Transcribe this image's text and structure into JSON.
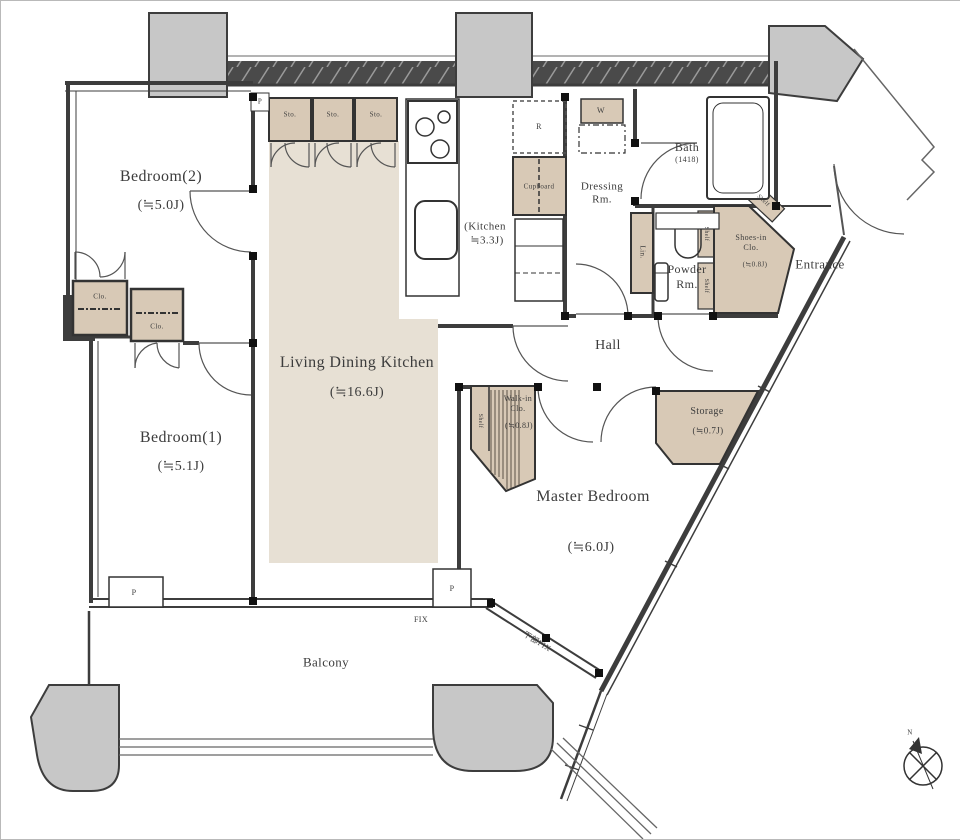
{
  "rooms": {
    "bedroom2": {
      "name": "Bedroom(2)",
      "size": "(≒5.0J)"
    },
    "bedroom1": {
      "name": "Bedroom(1)",
      "size": "(≒5.1J)"
    },
    "ldk": {
      "name": "Living Dining Kitchen",
      "size": "(≒16.6J)"
    },
    "kitchen": {
      "name": "(Kitchen",
      "size": "≒3.3J)"
    },
    "dressing": {
      "line1": "Dressing",
      "line2": "Rm."
    },
    "bath": {
      "name": "Bath",
      "size": "(1418)"
    },
    "powder": {
      "line1": "Powder",
      "line2": "Rm."
    },
    "hall": {
      "name": "Hall"
    },
    "master": {
      "name": "Master Bedroom",
      "size": "(≒6.0J)"
    },
    "walkin": {
      "line1": "Walk-in",
      "line2": "Clo.",
      "size": "(≒0.8J)"
    },
    "storage": {
      "name": "Storage",
      "size": "(≒0.7J)"
    },
    "shoesin": {
      "line1": "Shoes-in",
      "line2": "Clo.",
      "size": "(≒0.8J)"
    },
    "entrance": {
      "name": "Entrance"
    },
    "balcony": {
      "name": "Balcony"
    }
  },
  "fixtures": {
    "sto": "Sto.",
    "clo": "Clo.",
    "cupboard": "Cupboard",
    "fridge": "R",
    "washer": "W",
    "linen": "Lin.",
    "shelf": "Shelf",
    "pipe_space": "P",
    "fix": "FIX",
    "fix_lower": "下部FIX",
    "north": "N"
  },
  "colors": {
    "ldk_floor": "#e7e0d4",
    "fixture_tan": "#d8c9b6",
    "pillar_gray": "#c7c7c7",
    "wall_dark": "#3d3d3d"
  }
}
